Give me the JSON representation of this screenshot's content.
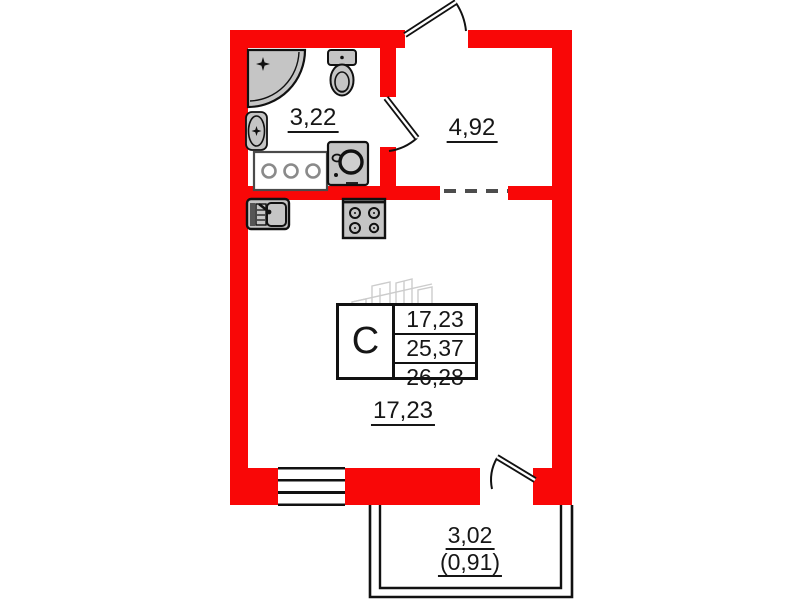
{
  "plan": {
    "rooms": [
      {
        "id": "bathroom",
        "area": "3,22"
      },
      {
        "id": "hallway",
        "area": "4,92"
      },
      {
        "id": "living-room",
        "area": "17,23"
      },
      {
        "id": "balcony",
        "area": "3,02",
        "area_coefficient": "(0,91)"
      }
    ],
    "info_box": {
      "unit_type": "С",
      "rows": [
        "17,23",
        "25,37",
        "26,28"
      ]
    },
    "fixtures": [
      "shower",
      "toilet",
      "sink",
      "cabinet",
      "washing-machine",
      "kitchen-sink",
      "stove"
    ],
    "colors": {
      "wall": "#f90707",
      "fixture": "#c5c5c5",
      "line": "#111111",
      "dash": "#4d4d4d",
      "watermark": "#cccccc"
    }
  }
}
